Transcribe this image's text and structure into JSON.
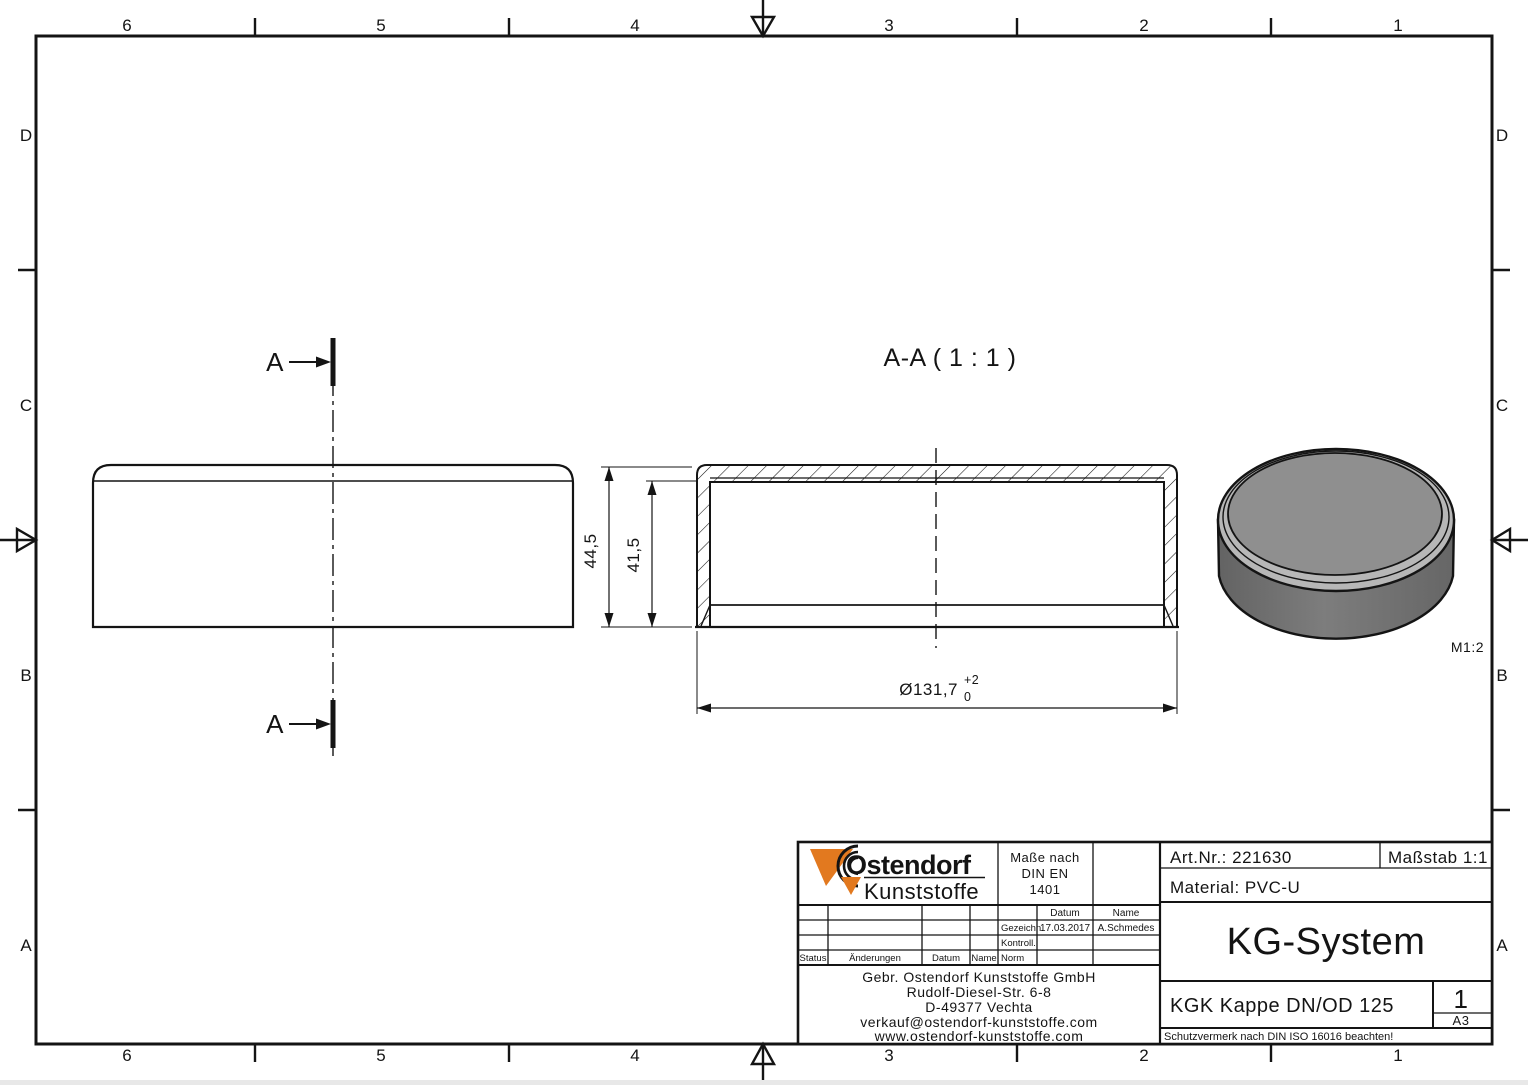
{
  "frame": {
    "zone_cols": [
      "6",
      "5",
      "4",
      "3",
      "2",
      "1"
    ],
    "zone_rows": [
      "D",
      "C",
      "B",
      "A"
    ]
  },
  "views": {
    "section_title": "A-A ( 1 : 1 )",
    "cut_label": "A",
    "iso_scale_label": "M1:2",
    "dims": {
      "height_outer": "44,5",
      "height_inner": "41,5",
      "diameter": "Ø131,7",
      "tol_upper": "+2",
      "tol_lower": "0"
    }
  },
  "title_block": {
    "logo": {
      "line1": "Ostendorf",
      "line2": "Kunststoffe"
    },
    "spec_note": {
      "line1": "Maße nach",
      "line2": "DIN EN",
      "line3": "1401"
    },
    "rev_table": {
      "col_status": "Status",
      "col_changes": "Änderungen",
      "col_date": "Datum",
      "col_name": "Name",
      "head_date": "Datum",
      "head_name": "Name",
      "row_drawn_label": "Gezeichn.",
      "row_drawn_date": "17.03.2017",
      "row_drawn_name": "A.Schmedes",
      "row_checked_label": "Kontroll.",
      "row_norm_label": "Norm"
    },
    "address": [
      "Gebr. Ostendorf Kunststoffe GmbH",
      "Rudolf-Diesel-Str. 6-8",
      "D-49377 Vechta",
      "verkauf@ostendorf-kunststoffe.com",
      "www.ostendorf-kunststoffe.com"
    ],
    "art_nr": "Art.Nr.: 221630",
    "scale": "Maßstab 1:1",
    "material": "Material: PVC-U",
    "system": "KG-System",
    "part_name": "KGK Kappe DN/OD 125",
    "sheet": "1",
    "format": "A3",
    "protection_note": "Schutzvermerk nach DIN ISO 16016 beachten!"
  },
  "colors": {
    "brand_orange": "#e2791f",
    "line": "#141414",
    "puck_top": "#8f8f8f",
    "puck_side": "#6f6f6f",
    "puck_rim": "#b7b7b7"
  }
}
